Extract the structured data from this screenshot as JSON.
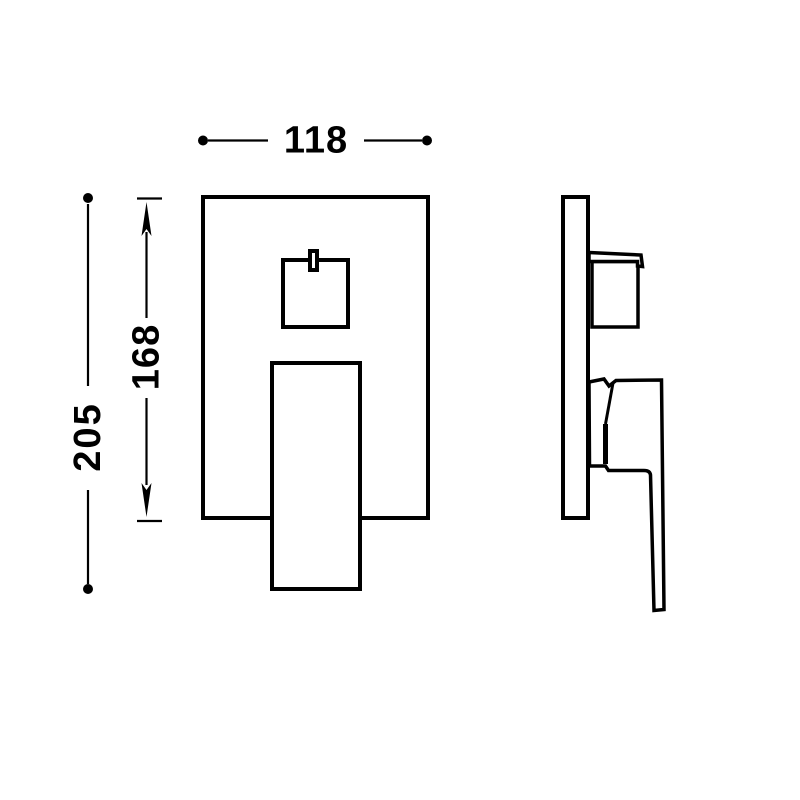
{
  "drawing": {
    "background_color": "#ffffff",
    "line_color": "#000000",
    "dimensions": {
      "width": "118",
      "overall_height": "205",
      "plate_height": "168"
    }
  }
}
